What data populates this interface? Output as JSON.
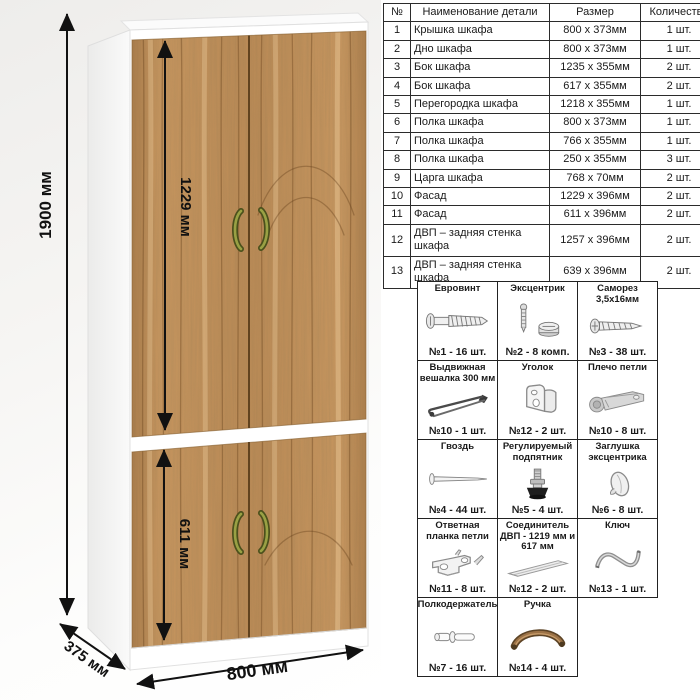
{
  "drawing": {
    "height_label": "1900 мм",
    "upper_door_label": "1229 мм",
    "lower_door_label": "611 мм",
    "width_label": "800 мм",
    "depth_label": "375 мм",
    "colors": {
      "wood": "#c8965f",
      "carcass": "#ffffff",
      "handle": "#7c8136",
      "dimension": "#111111"
    }
  },
  "parts_table": {
    "headers": [
      "№",
      "Наименование детали",
      "Размер",
      "Количество"
    ],
    "rows": [
      {
        "num": "1",
        "name": "Крышка шкафа",
        "size": "800 x 373мм",
        "qty": "1 шт."
      },
      {
        "num": "2",
        "name": "Дно шкафа",
        "size": "800 x 373мм",
        "qty": "1 шт."
      },
      {
        "num": "3",
        "name": "Бок шкафа",
        "size": "1235 x 355мм",
        "qty": "2 шт."
      },
      {
        "num": "4",
        "name": "Бок шкафа",
        "size": "617 x 355мм",
        "qty": "2 шт."
      },
      {
        "num": "5",
        "name": "Перегородка шкафа",
        "size": "1218 x 355мм",
        "qty": "1 шт."
      },
      {
        "num": "6",
        "name": "Полка шкафа",
        "size": "800 x 373мм",
        "qty": "1 шт."
      },
      {
        "num": "7",
        "name": "Полка шкафа",
        "size": "766 x 355мм",
        "qty": "1 шт."
      },
      {
        "num": "8",
        "name": "Полка шкафа",
        "size": "250 x 355мм",
        "qty": "3 шт."
      },
      {
        "num": "9",
        "name": "Царга шкафа",
        "size": "768 x 70мм",
        "qty": "2 шт."
      },
      {
        "num": "10",
        "name": "Фасад",
        "size": "1229 x 396мм",
        "qty": "2 шт."
      },
      {
        "num": "11",
        "name": "Фасад",
        "size": "611 x 396мм",
        "qty": "2 шт."
      },
      {
        "num": "12",
        "name": "ДВП – задняя стенка шкафа",
        "size": "1257 x 396мм",
        "qty": "2 шт."
      },
      {
        "num": "13",
        "name": "ДВП – задняя стенка шкафа",
        "size": "639 x 396мм",
        "qty": "2 шт."
      }
    ]
  },
  "hardware": {
    "items": [
      {
        "title": "Евровинт",
        "count": "№1 - 16 шт."
      },
      {
        "title": "Эксцентрик",
        "count": "№2 - 8 комп."
      },
      {
        "title": "Саморез 3,5х16мм",
        "count": "№3 - 38 шт."
      },
      {
        "title": "Выдвижная вешалка 300 мм",
        "count": "№10 - 1 шт."
      },
      {
        "title": "Уголок",
        "count": "№12 - 2 шт."
      },
      {
        "title": "Плечо петли",
        "count": "№10 - 8 шт."
      },
      {
        "title": "Гвоздь",
        "count": "№4 - 44 шт."
      },
      {
        "title": "Регулируемый подпятник",
        "count": "№5 - 4 шт."
      },
      {
        "title": "Заглушка эксцентрика",
        "count": "№6 - 8 шт."
      },
      {
        "title": "Ответная планка петли",
        "count": "№11 - 8 шт."
      },
      {
        "title": "Соединитель ДВП - 1219 мм и 617 мм",
        "count": "№12 - 2 шт."
      },
      {
        "title": "Ключ",
        "count": "№13 - 1 шт."
      },
      {
        "title": "Полкодержатель",
        "count": "№7 - 16 шт."
      },
      {
        "title": "Ручка",
        "count": "№14 - 4 шт."
      }
    ]
  }
}
